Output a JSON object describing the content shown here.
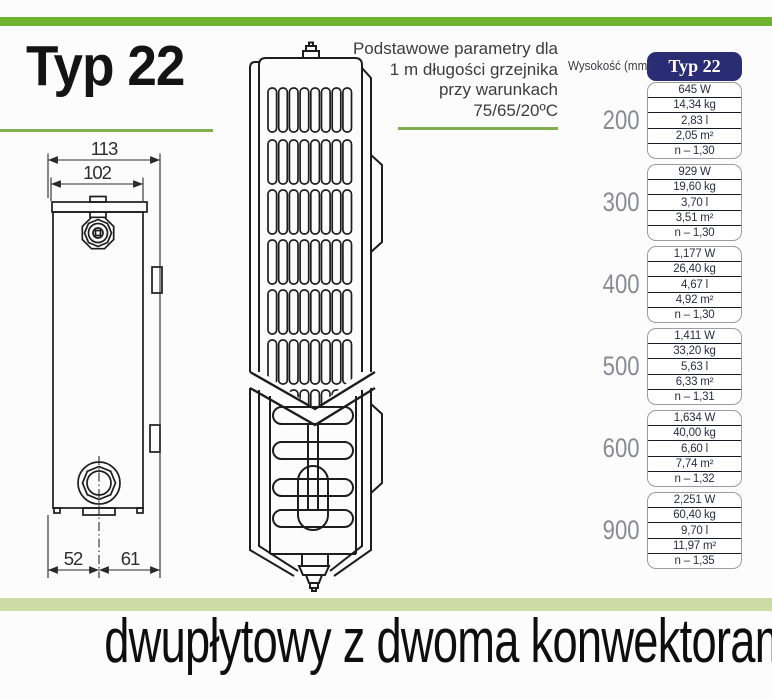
{
  "header": {
    "title": "Typ 22",
    "note_lines": [
      "Podstawowe parametry dla",
      "1 m długości grzejnika",
      "przy warunkach",
      "75/65/20ºC"
    ]
  },
  "drawing": {
    "side_view": {
      "dims": [
        "113",
        "102",
        "52",
        "61"
      ]
    }
  },
  "table": {
    "height_header": "Wysokość (mm)",
    "type_header": "Typ 22",
    "groups": [
      {
        "height": "200",
        "values": [
          "645 W",
          "14,34 kg",
          "2,83 l",
          "2,05 m²",
          "n – 1,30"
        ]
      },
      {
        "height": "300",
        "values": [
          "929 W",
          "19,60 kg",
          "3,70 l",
          "3,51 m²",
          "n – 1,30"
        ]
      },
      {
        "height": "400",
        "values": [
          "1,177 W",
          "26,40 kg",
          "4,67 l",
          "4,92 m²",
          "n – 1,30"
        ]
      },
      {
        "height": "500",
        "values": [
          "1,411 W",
          "33,20 kg",
          "5,63 l",
          "6,33 m²",
          "n – 1,31"
        ]
      },
      {
        "height": "600",
        "values": [
          "1,634 W",
          "40,00 kg",
          "6,60 l",
          "7,74 m²",
          "n – 1,32"
        ]
      },
      {
        "height": "900",
        "values": [
          "2,251 W",
          "60,40 kg",
          "9,70 l",
          "11,97 m²",
          "n – 1,35"
        ]
      }
    ]
  },
  "footer": {
    "caption": "dwupłytowy z dwoma konwektorami"
  },
  "colors": {
    "accent_green": "#6db331",
    "underline_green": "#7fae4e",
    "band_green": "#cbdda4",
    "navy": "#2a2c74",
    "height_label_gray": "#8a8a93"
  }
}
